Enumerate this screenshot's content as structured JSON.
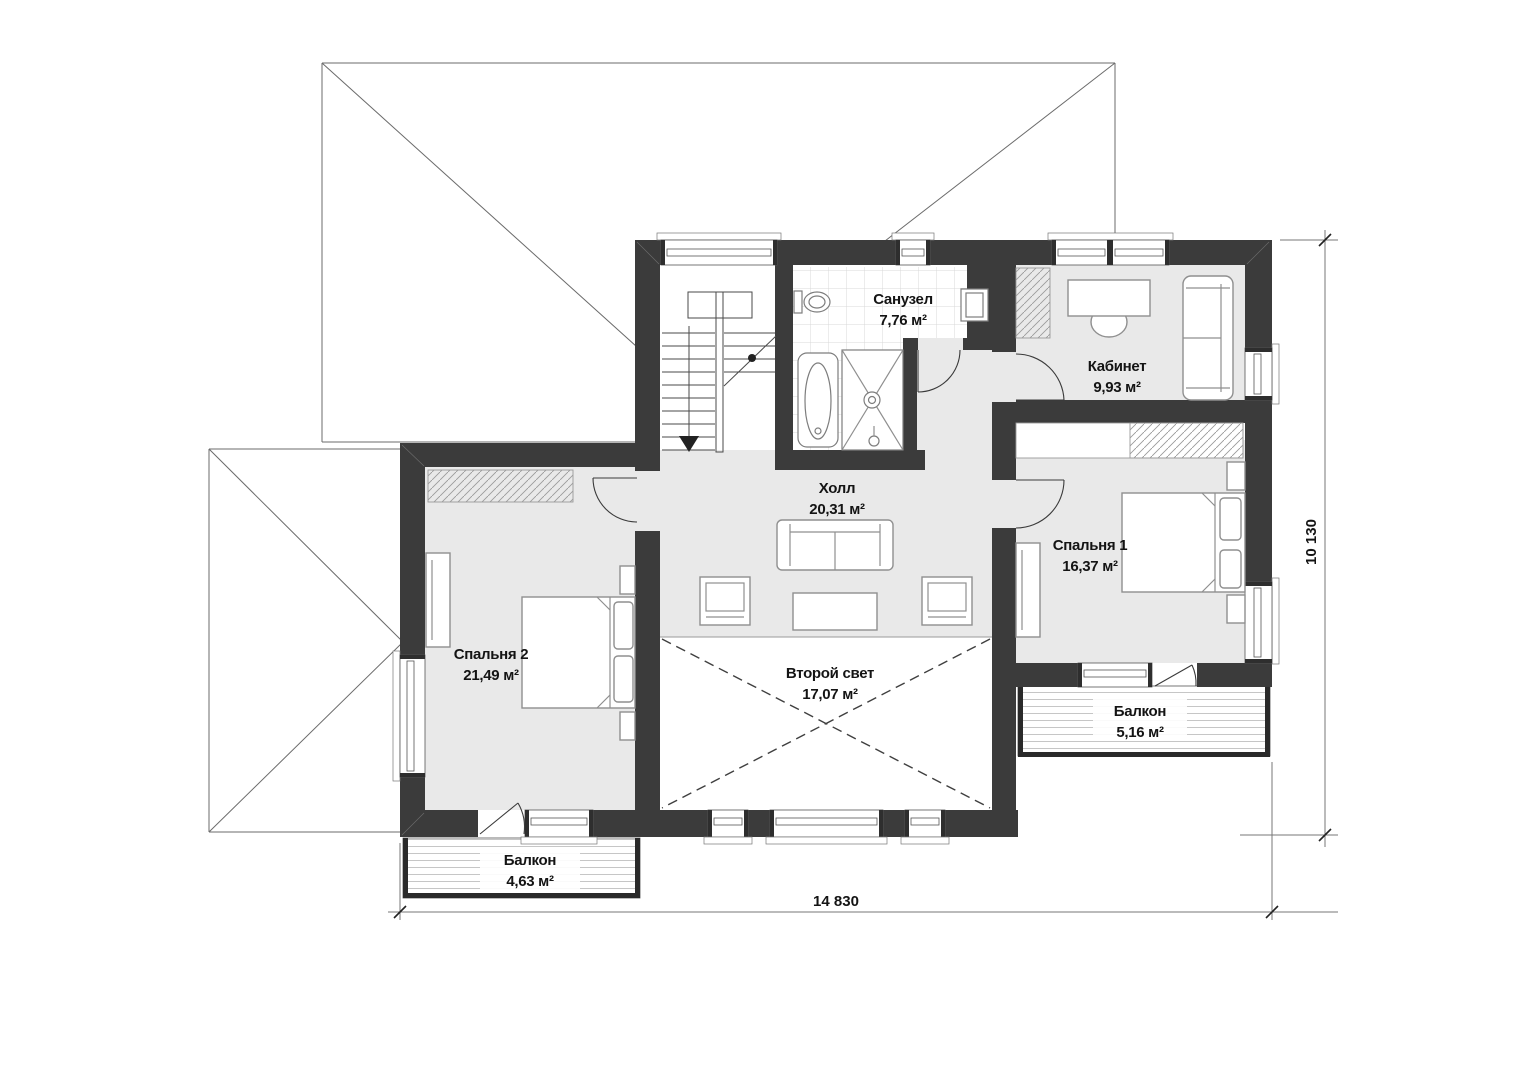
{
  "floor_plan": {
    "type": "architectural-floor-plan",
    "floor": "second",
    "rooms": [
      {
        "id": "bathroom",
        "name": "Санузел",
        "area": "7,76 м²"
      },
      {
        "id": "office",
        "name": "Кабинет",
        "area": "9,93 м²"
      },
      {
        "id": "hall",
        "name": "Холл",
        "area": "20,31 м²"
      },
      {
        "id": "bedroom1",
        "name": "Спальня 1",
        "area": "16,37 м²"
      },
      {
        "id": "bedroom2",
        "name": "Спальня 2",
        "area": "21,49 м²"
      },
      {
        "id": "second_light",
        "name": "Второй свет",
        "area": "17,07 м²"
      },
      {
        "id": "balcony_right",
        "name": "Балкон",
        "area": "5,16 м²"
      },
      {
        "id": "balcony_bottom",
        "name": "Балкон",
        "area": "4,63 м²"
      }
    ],
    "dimensions": {
      "width_label": "14 830",
      "height_label": "10 130"
    },
    "colors": {
      "wall": "#3b3b3b",
      "room_fill": "#e9e9e9",
      "background": "#ffffff",
      "roof_line": "#6b6b6b",
      "furniture_stroke": "#8f8f8f",
      "text": "#141414"
    },
    "symbols": [
      "stairs-down-arrow",
      "door-swing-arcs",
      "double-height-void-dashed-cross",
      "dimension-ticks"
    ]
  }
}
